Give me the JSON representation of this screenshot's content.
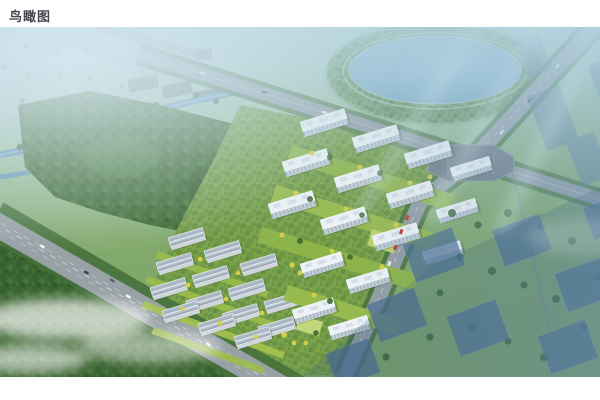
{
  "page": {
    "background_color": "#ffffff",
    "caption": "鸟瞰图",
    "caption_color": "#43474b"
  },
  "rendering": {
    "subject": "aerial-birdseye-rendering-of-residential-development",
    "palette": {
      "sky_haze": "#b9d3de",
      "lake_water": "#78a9c4",
      "river_water": "#5f90b2",
      "forest_green": "#3c672f",
      "lawn_green": "#8cb449",
      "accent_tree_yellow": "#d6cf48",
      "road_gray": "#939da3",
      "building_white": "#eef3f6",
      "villa_roof_gray": "#9fadbb",
      "context_building_blue": "#4a6d92"
    }
  }
}
